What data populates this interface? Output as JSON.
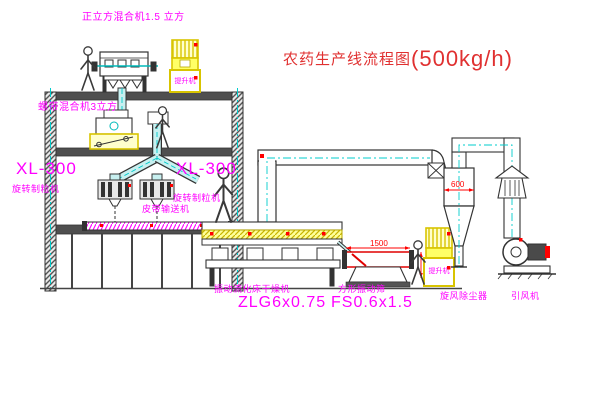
{
  "title": {
    "name": "农药生产线流程图",
    "capacity": "(500kg/h)"
  },
  "labels": {
    "cube_mixer": "正立方混合机1.5 立方",
    "ribbon_mixer": "螺带混合机3立方",
    "granulator_left_model": "XL-300",
    "granulator_left_name": "旋转制粒机",
    "granulator_right_model": "XL-300",
    "granulator_right_name": "旋转制粒机",
    "belt_conveyor": "皮带输送机",
    "dryer_name": "振动流化床干燥机",
    "dryer_model": "ZLG6x0.75",
    "sieve_name": "方形振动筛",
    "sieve_model": "FS0.6x1.5",
    "cyclone": "旋风除尘器",
    "fan": "引风机",
    "elevator_top": "提升机",
    "elevator_bottom": "提升机"
  },
  "dimensions": {
    "sieve_length": "1500",
    "cyclone_diameter": "600"
  },
  "colors": {
    "label": "#ff00ff",
    "title": "#e03030",
    "dimension": "#ff0000",
    "pipe_centerline": "#00cccc",
    "equipment_accent": "#f0e000"
  }
}
